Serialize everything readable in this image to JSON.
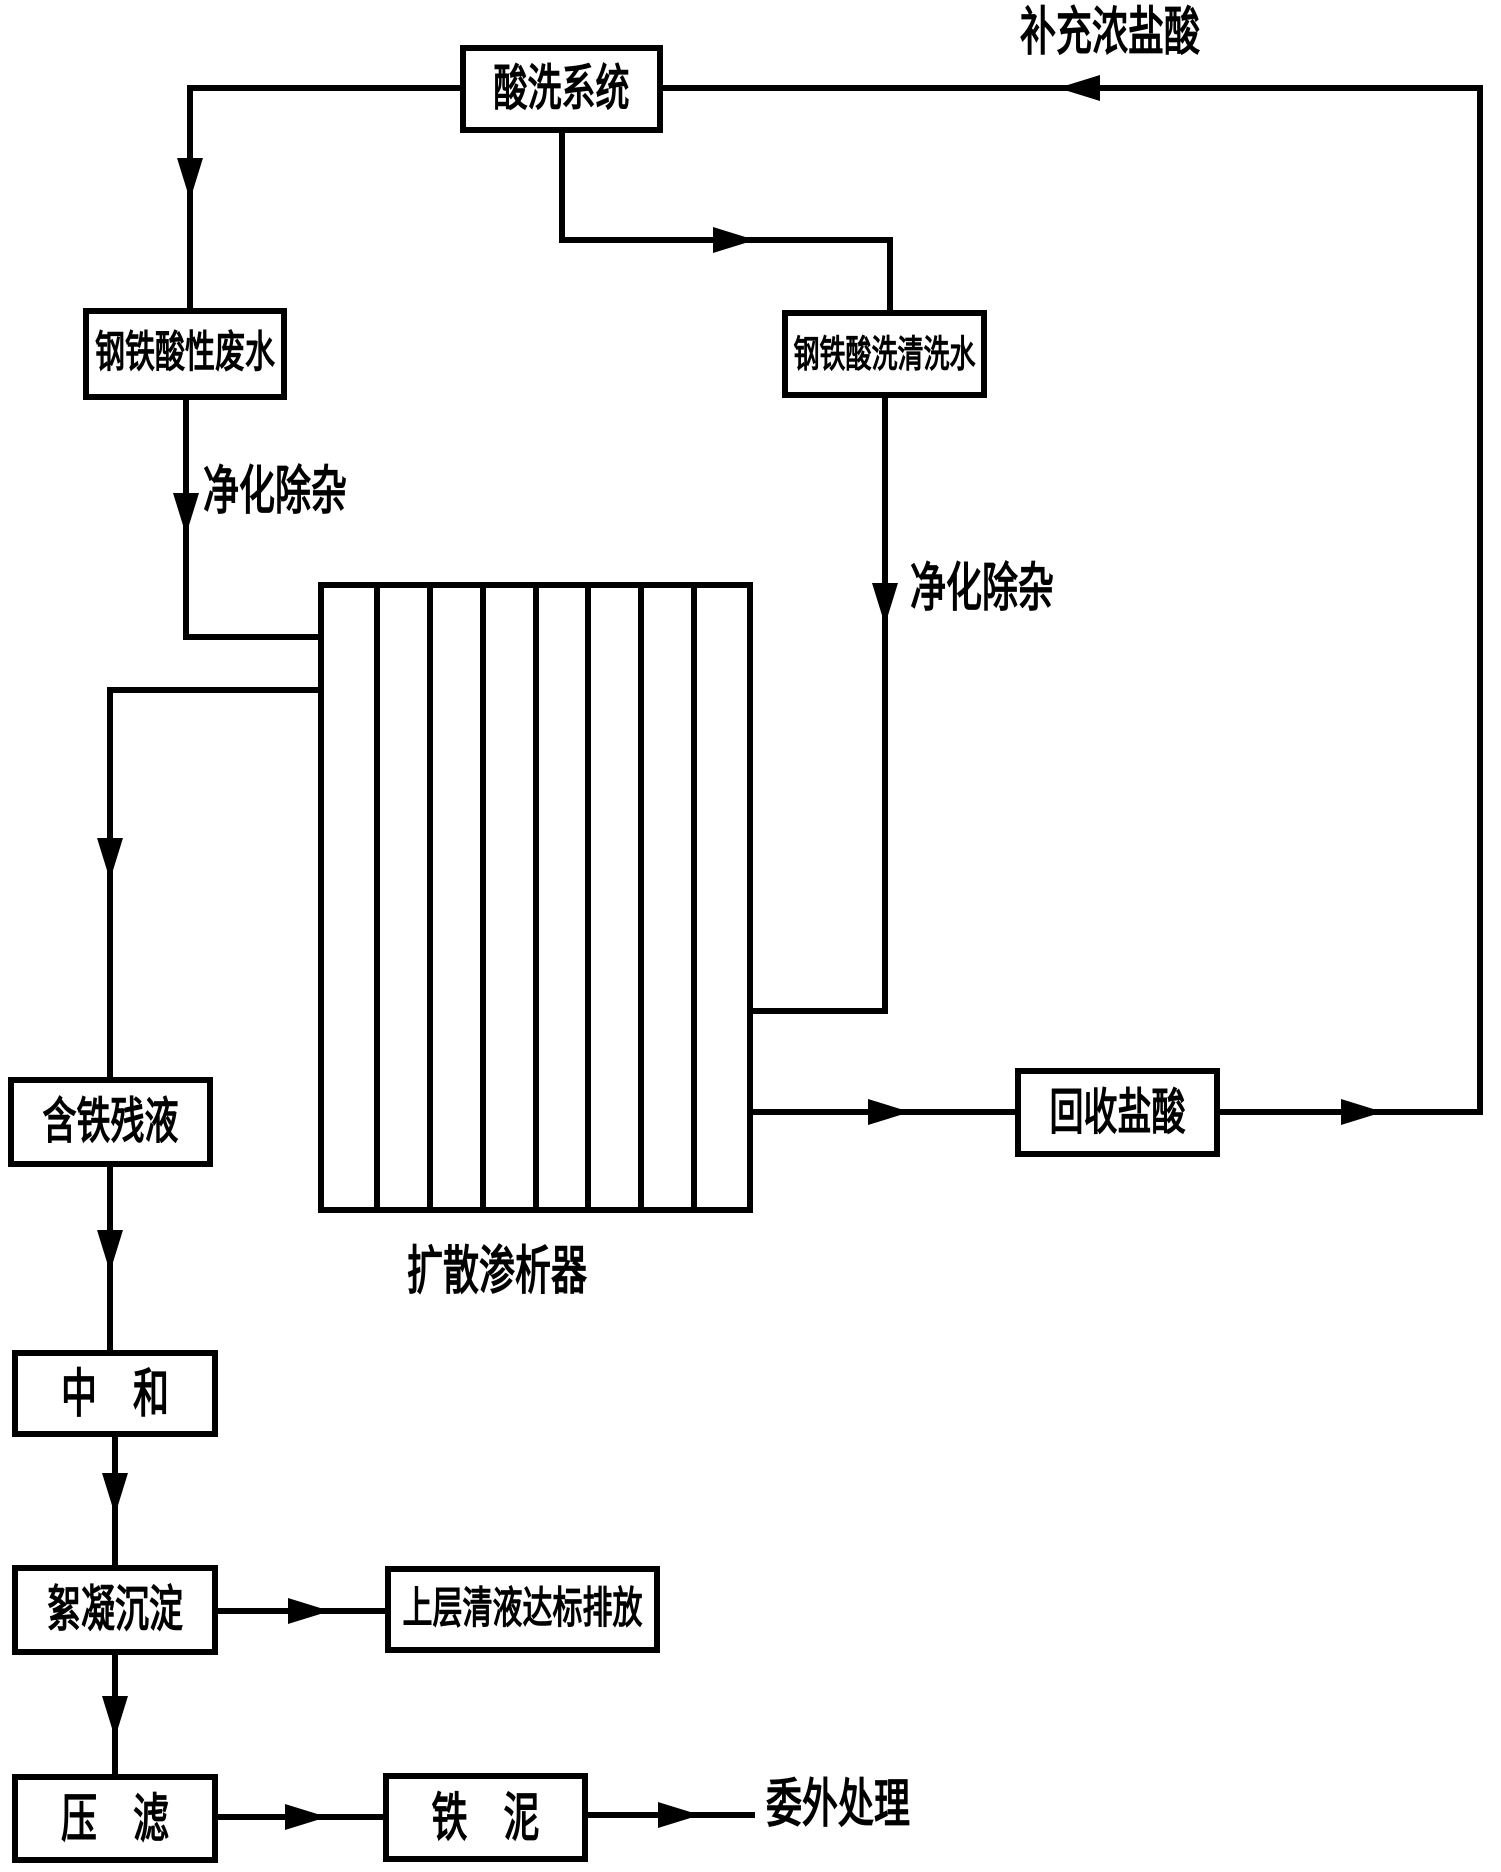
{
  "nodes": {
    "pickling_system": "酸洗系统",
    "steel_acid_wastewater": "钢铁酸性废水",
    "steel_pickling_rinse_water": "钢铁酸洗清洗水",
    "iron_residual_liquid": "含铁残液",
    "recovered_hcl": "回收盐酸",
    "neutralization": "中　和",
    "flocculation_sedimentation": "絮凝沉淀",
    "supernatant_discharge": "上层清液达标排放",
    "press_filtration": "压　滤",
    "iron_sludge": "铁　泥"
  },
  "flow_labels": {
    "makeup_concentrated_hcl": "补充浓盐酸",
    "purify_impurity_removal_left": "净化除杂",
    "purify_impurity_removal_right": "净化除杂",
    "outsourced_treatment": "委外处理"
  },
  "dialyzer": {
    "label": "扩散渗析器",
    "channels": 8
  },
  "colors": {
    "line": "#000000",
    "background": "#ffffff"
  }
}
